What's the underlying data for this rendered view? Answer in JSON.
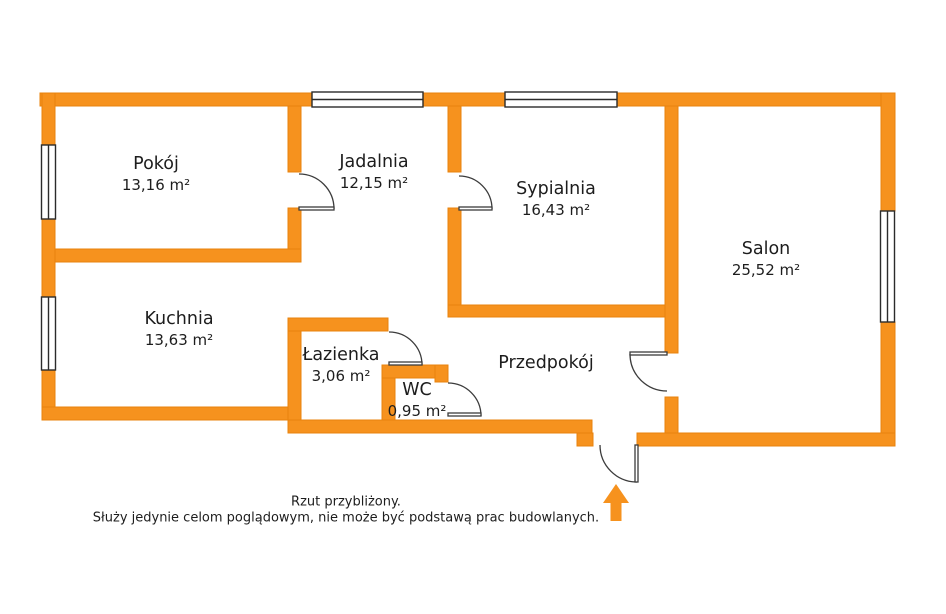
{
  "plan_title": "apartment-floor-plan",
  "rooms": {
    "pokoj": {
      "name": "Pokój",
      "area": "13,16 m²"
    },
    "jadalnia": {
      "name": "Jadalnia",
      "area": "12,15 m²"
    },
    "sypialnia": {
      "name": "Sypialnia",
      "area": "16,43 m²"
    },
    "salon": {
      "name": "Salon",
      "area": "25,52 m²"
    },
    "kuchnia": {
      "name": "Kuchnia",
      "area": "13,63 m²"
    },
    "lazienka": {
      "name": "Łazienka",
      "area": "3,06 m²"
    },
    "wc": {
      "name": "WC",
      "area": "0,95 m²"
    },
    "przedpokoj": {
      "name": "Przedpokój"
    }
  },
  "disclaimer": {
    "line1": "Rzut przybliżony.",
    "line2": "Służy jedynie celom poglądowym, nie może być podstawą prac budowlanych."
  },
  "colors": {
    "wall": "#F6921E",
    "wall_edge": "#E8830D",
    "door_line": "#3c3c3c",
    "window_border": "#2b2b2b",
    "text": "#1d1d1d"
  },
  "icons": {
    "entrance_arrow": "up-arrow"
  }
}
